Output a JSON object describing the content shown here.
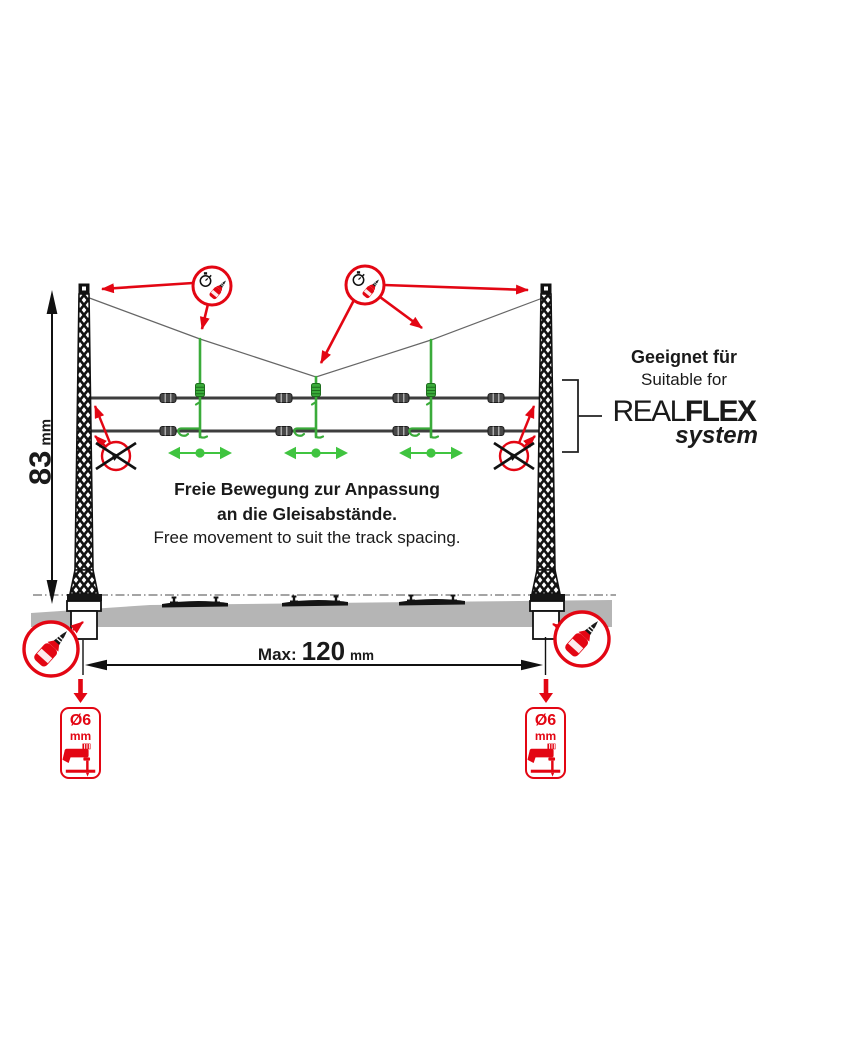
{
  "headline": {
    "de": "Geeignet für",
    "en": "Suitable for"
  },
  "brand": {
    "real": "REAL",
    "flex": "FLEX",
    "system": "system"
  },
  "movement": {
    "de_line1": "Freie Bewegung zur Anpassung",
    "de_line2": "an die Gleisabstände.",
    "en": "Free movement to suit the track spacing."
  },
  "dimensions": {
    "mast_height": {
      "value": "83",
      "unit": "mm"
    },
    "track_spacing": {
      "label": "Max:",
      "value": "120",
      "unit": "mm"
    },
    "drill_hole": {
      "size": "Ø6",
      "unit": "mm"
    }
  },
  "icons": {
    "glue_and_wait": "red circle with glue bottle and stopwatch - glue and let set",
    "no_glue": "red circle crossed out - do not glue here",
    "glue": "red circle with glue bottle - apply glue",
    "drill": "drill a hole Ø6 mm",
    "free_movement_arrow": "green double arrow - part slides freely"
  },
  "colors": {
    "red": "#e30613",
    "green": "#3aab3a",
    "green_arrow": "#40c440",
    "wire": "#3e3e3e",
    "ballast": "#b5b5b5"
  }
}
